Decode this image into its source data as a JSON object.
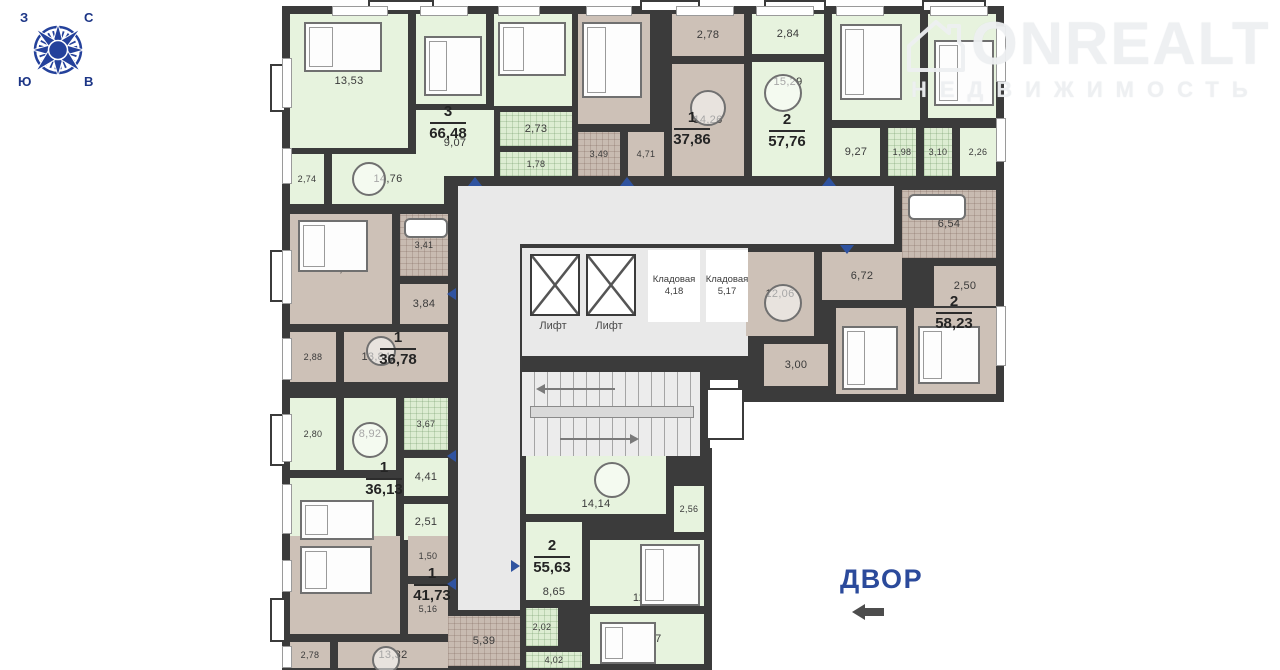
{
  "compass": {
    "w": "З",
    "n": "С",
    "s": "Ю",
    "e": "В"
  },
  "watermark": {
    "brand": "ONREALT",
    "subtitle": "НЕДВИЖИМОСТЬ"
  },
  "courtyard": {
    "label": "ДВОР"
  },
  "core": {
    "lift": "Лифт",
    "storage_label": "Кладовая",
    "storage1_area": "4,18",
    "storage2_area": "5,17"
  },
  "apartments": {
    "a": {
      "num": "3",
      "area": "66,48"
    },
    "b": {
      "num": "1",
      "area": "37,86"
    },
    "c": {
      "num": "2",
      "area": "57,76"
    },
    "d": {
      "num": "2",
      "area": "58,23"
    },
    "e": {
      "num": "1",
      "area": "36,78"
    },
    "f": {
      "num": "1",
      "area": "36,13"
    },
    "g": {
      "num": "1",
      "area": "41,73"
    },
    "h": {
      "num": "2",
      "area": "55,63"
    }
  },
  "rooms": {
    "a1": "13,53",
    "a2": "10,53",
    "a3": "11,34",
    "a4": "2,73",
    "a5": "1,78",
    "a6": "9,07",
    "a7": "14,76",
    "a8": "2,74",
    "b1": "12,62",
    "b2": "2,78",
    "b3": "14,26",
    "b4": "3,49",
    "b5": "4,71",
    "c1": "2,84",
    "c2": "15,29",
    "c3": "11,26",
    "c4": "11,76",
    "c5": "9,27",
    "c6": "1,98",
    "c7": "3,10",
    "c8": "2,26",
    "d1": "6,54",
    "d2": "2,50",
    "d3": "12,06",
    "d4": "6,72",
    "d5": "3,00",
    "d6": "13,20",
    "d7": "14,21",
    "e1": "12,81",
    "e2": "3,41",
    "e3": "3,84",
    "e4": "2,88",
    "e5": "13,84",
    "f1": "2,80",
    "f2": "8,92",
    "f3": "3,67",
    "f4": "4,41",
    "f5": "13,82",
    "f6": "2,51",
    "g1": "13,58",
    "g2": "1,50",
    "g3": "5,16",
    "g4": "2,78",
    "g5": "13,32",
    "g6": "5,39",
    "h1": "14,14",
    "h2": "2,56",
    "h3": "11,37",
    "h4": "8,65",
    "h5": "2,02",
    "h6": "12,87",
    "h7": "4,02"
  },
  "colors": {
    "wall": "#3b3b3b",
    "room_green": "#e7f3de",
    "room_brown": "#cdc1b7",
    "corridor": "#e9e9e9",
    "accent_blue": "#2b4a9b",
    "door_marker": "#2f53a0"
  }
}
